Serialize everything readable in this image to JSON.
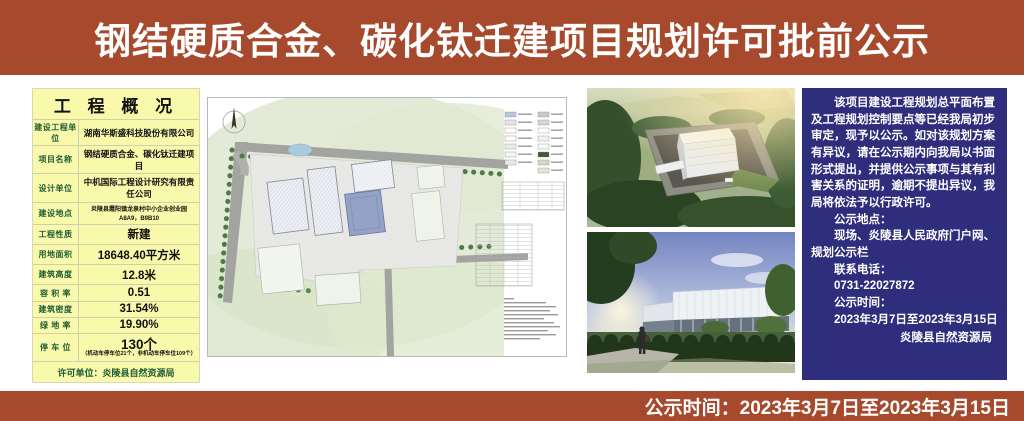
{
  "banner": {
    "title": "钢结硬质合金、碳化钛迁建项目规划许可批前公示"
  },
  "footer_banner": {
    "text": "公示时间：2023年3月7日至2023年3月15日"
  },
  "project_table": {
    "title": "工 程 概 况",
    "rows": [
      {
        "label": "建设工程单位",
        "value": "湖南华斯盛科技股份有限公司"
      },
      {
        "label": "项目名称",
        "value": "钢结硬质合金、碳化钛迁建项目"
      },
      {
        "label": "设计单位",
        "value": "中机国际工程设计研究有限责任公司"
      },
      {
        "label": "建设地点",
        "value": "炎陵县霞阳镇龙泉村中小企业创业园A8A9，B9B10"
      },
      {
        "label": "工程性质",
        "value": "新建"
      },
      {
        "label": "用地面积",
        "value": "18648.40平方米"
      },
      {
        "label": "建筑高度",
        "value": "12.8米"
      },
      {
        "label": "容 积 率",
        "value": "0.51"
      },
      {
        "label": "建筑密度",
        "value": "31.54%"
      },
      {
        "label": "绿 地 率",
        "value": "19.90%"
      },
      {
        "label": "停 车 位",
        "value": "130个"
      }
    ],
    "parking_note": "（机动车停车位21个，非机动车停车位109个）",
    "footer": "许可单位：炎陵县自然资源局"
  },
  "notice_panel": {
    "paragraphs": [
      "该项目建设工程规划总平面布置及工程规划控制要点等已经我局初步审定，现予以公示。如对该规划方案有异议，请在公示期内向我局以书面形式提出，并提供公示事项与其有利害关系的证明，逾期不提出异议，我局将依法予以行政许可。",
      "公示地点：",
      "现场、炎陵县人民政府门户网、规划公示栏",
      "联系电话：",
      "0731-22027872",
      "公示时间：",
      "2023年3月7日至2023年3月15日",
      "炎陵县自然资源局"
    ]
  },
  "colors": {
    "banner_red": "#a7492c",
    "table_yellow": "#f8f9ab",
    "label_green": "#1e5c34",
    "panel_blue": "#2e2e7d"
  }
}
